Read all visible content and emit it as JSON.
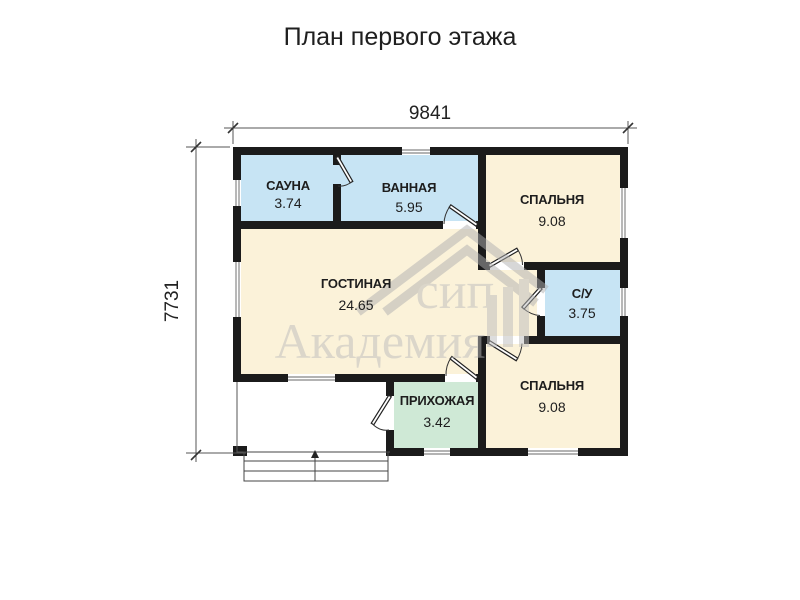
{
  "title": "План первого этажа",
  "dimensions": {
    "width": "9841",
    "height": "7731"
  },
  "rooms": [
    {
      "name": "САУНА",
      "area": "3.74"
    },
    {
      "name": "ВАННАЯ",
      "area": "5.95"
    },
    {
      "name": "СПАЛЬНЯ",
      "area": "9.08"
    },
    {
      "name": "С/У",
      "area": "3.75"
    },
    {
      "name": "СПАЛЬНЯ",
      "area": "9.08"
    },
    {
      "name": "ГОСТИНАЯ",
      "area": "24.65"
    },
    {
      "name": "ПРИХОЖАЯ",
      "area": "3.42"
    }
  ],
  "watermark": {
    "line1": "сип",
    "line2": "Академия"
  },
  "colors": {
    "wall": "#1b1b1b",
    "wet_room": "#c7e4f4",
    "living_room": "#fbf2d9",
    "hallway": "#cfe9d6",
    "watermark": "#bcbcbc"
  }
}
